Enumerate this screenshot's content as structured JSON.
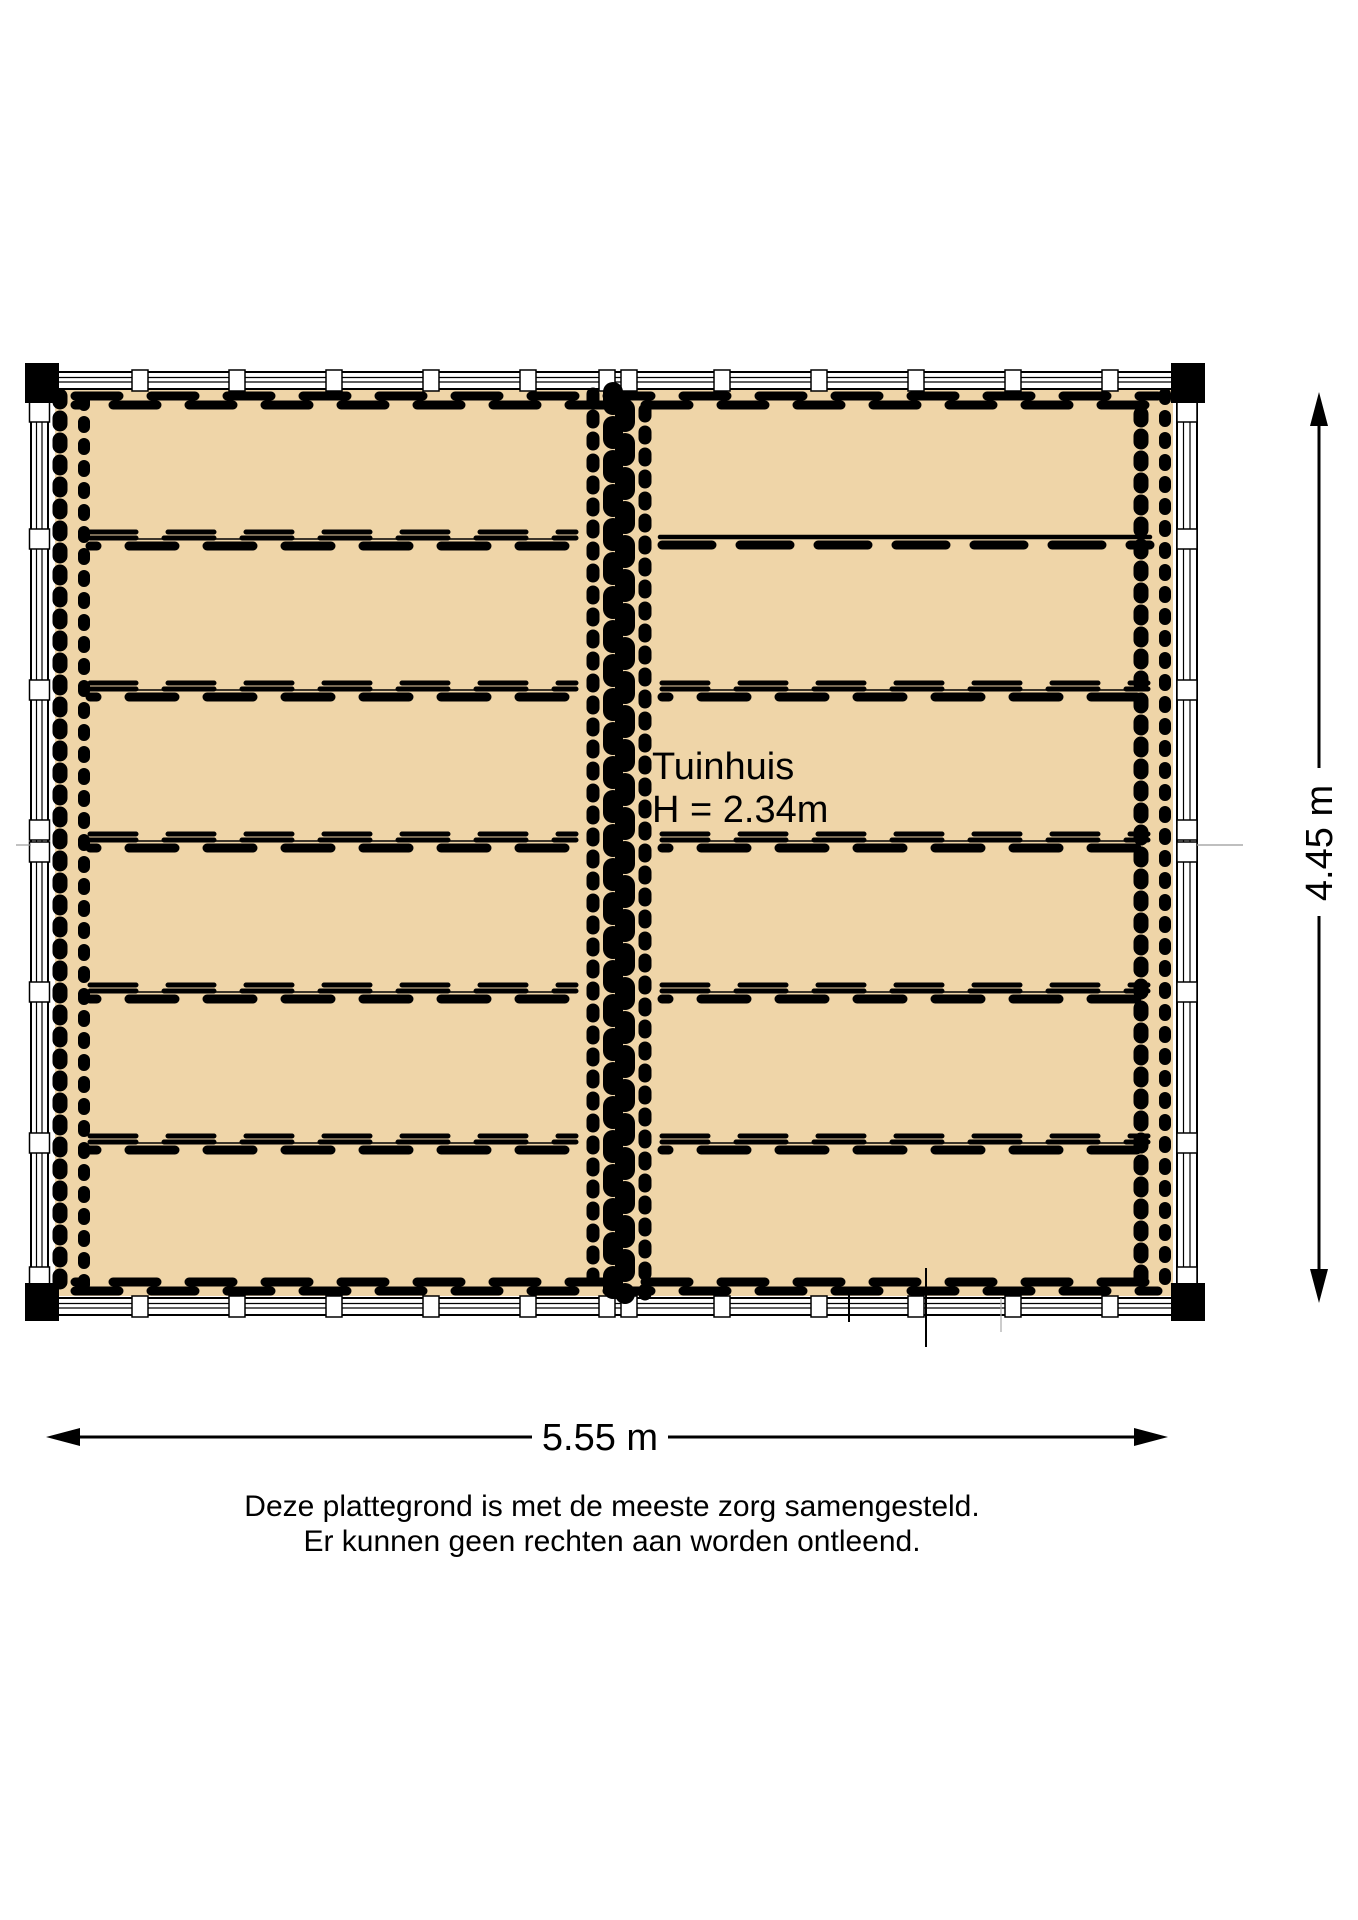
{
  "plan": {
    "room_label": "Tuinhuis",
    "room_height": "H = 2.34m",
    "dimensions": {
      "width": "5.55 m",
      "height": "4.45 m"
    }
  },
  "disclaimer": {
    "line1": "Deze plattegrond is met de meeste zorg samengesteld.",
    "line2": "Er kunnen geen rechten aan worden ontleend."
  },
  "colors": {
    "floor": "#EFD5A8",
    "line": "#000000",
    "wall": "#FFFFFF",
    "background": "#FFFFFF"
  }
}
